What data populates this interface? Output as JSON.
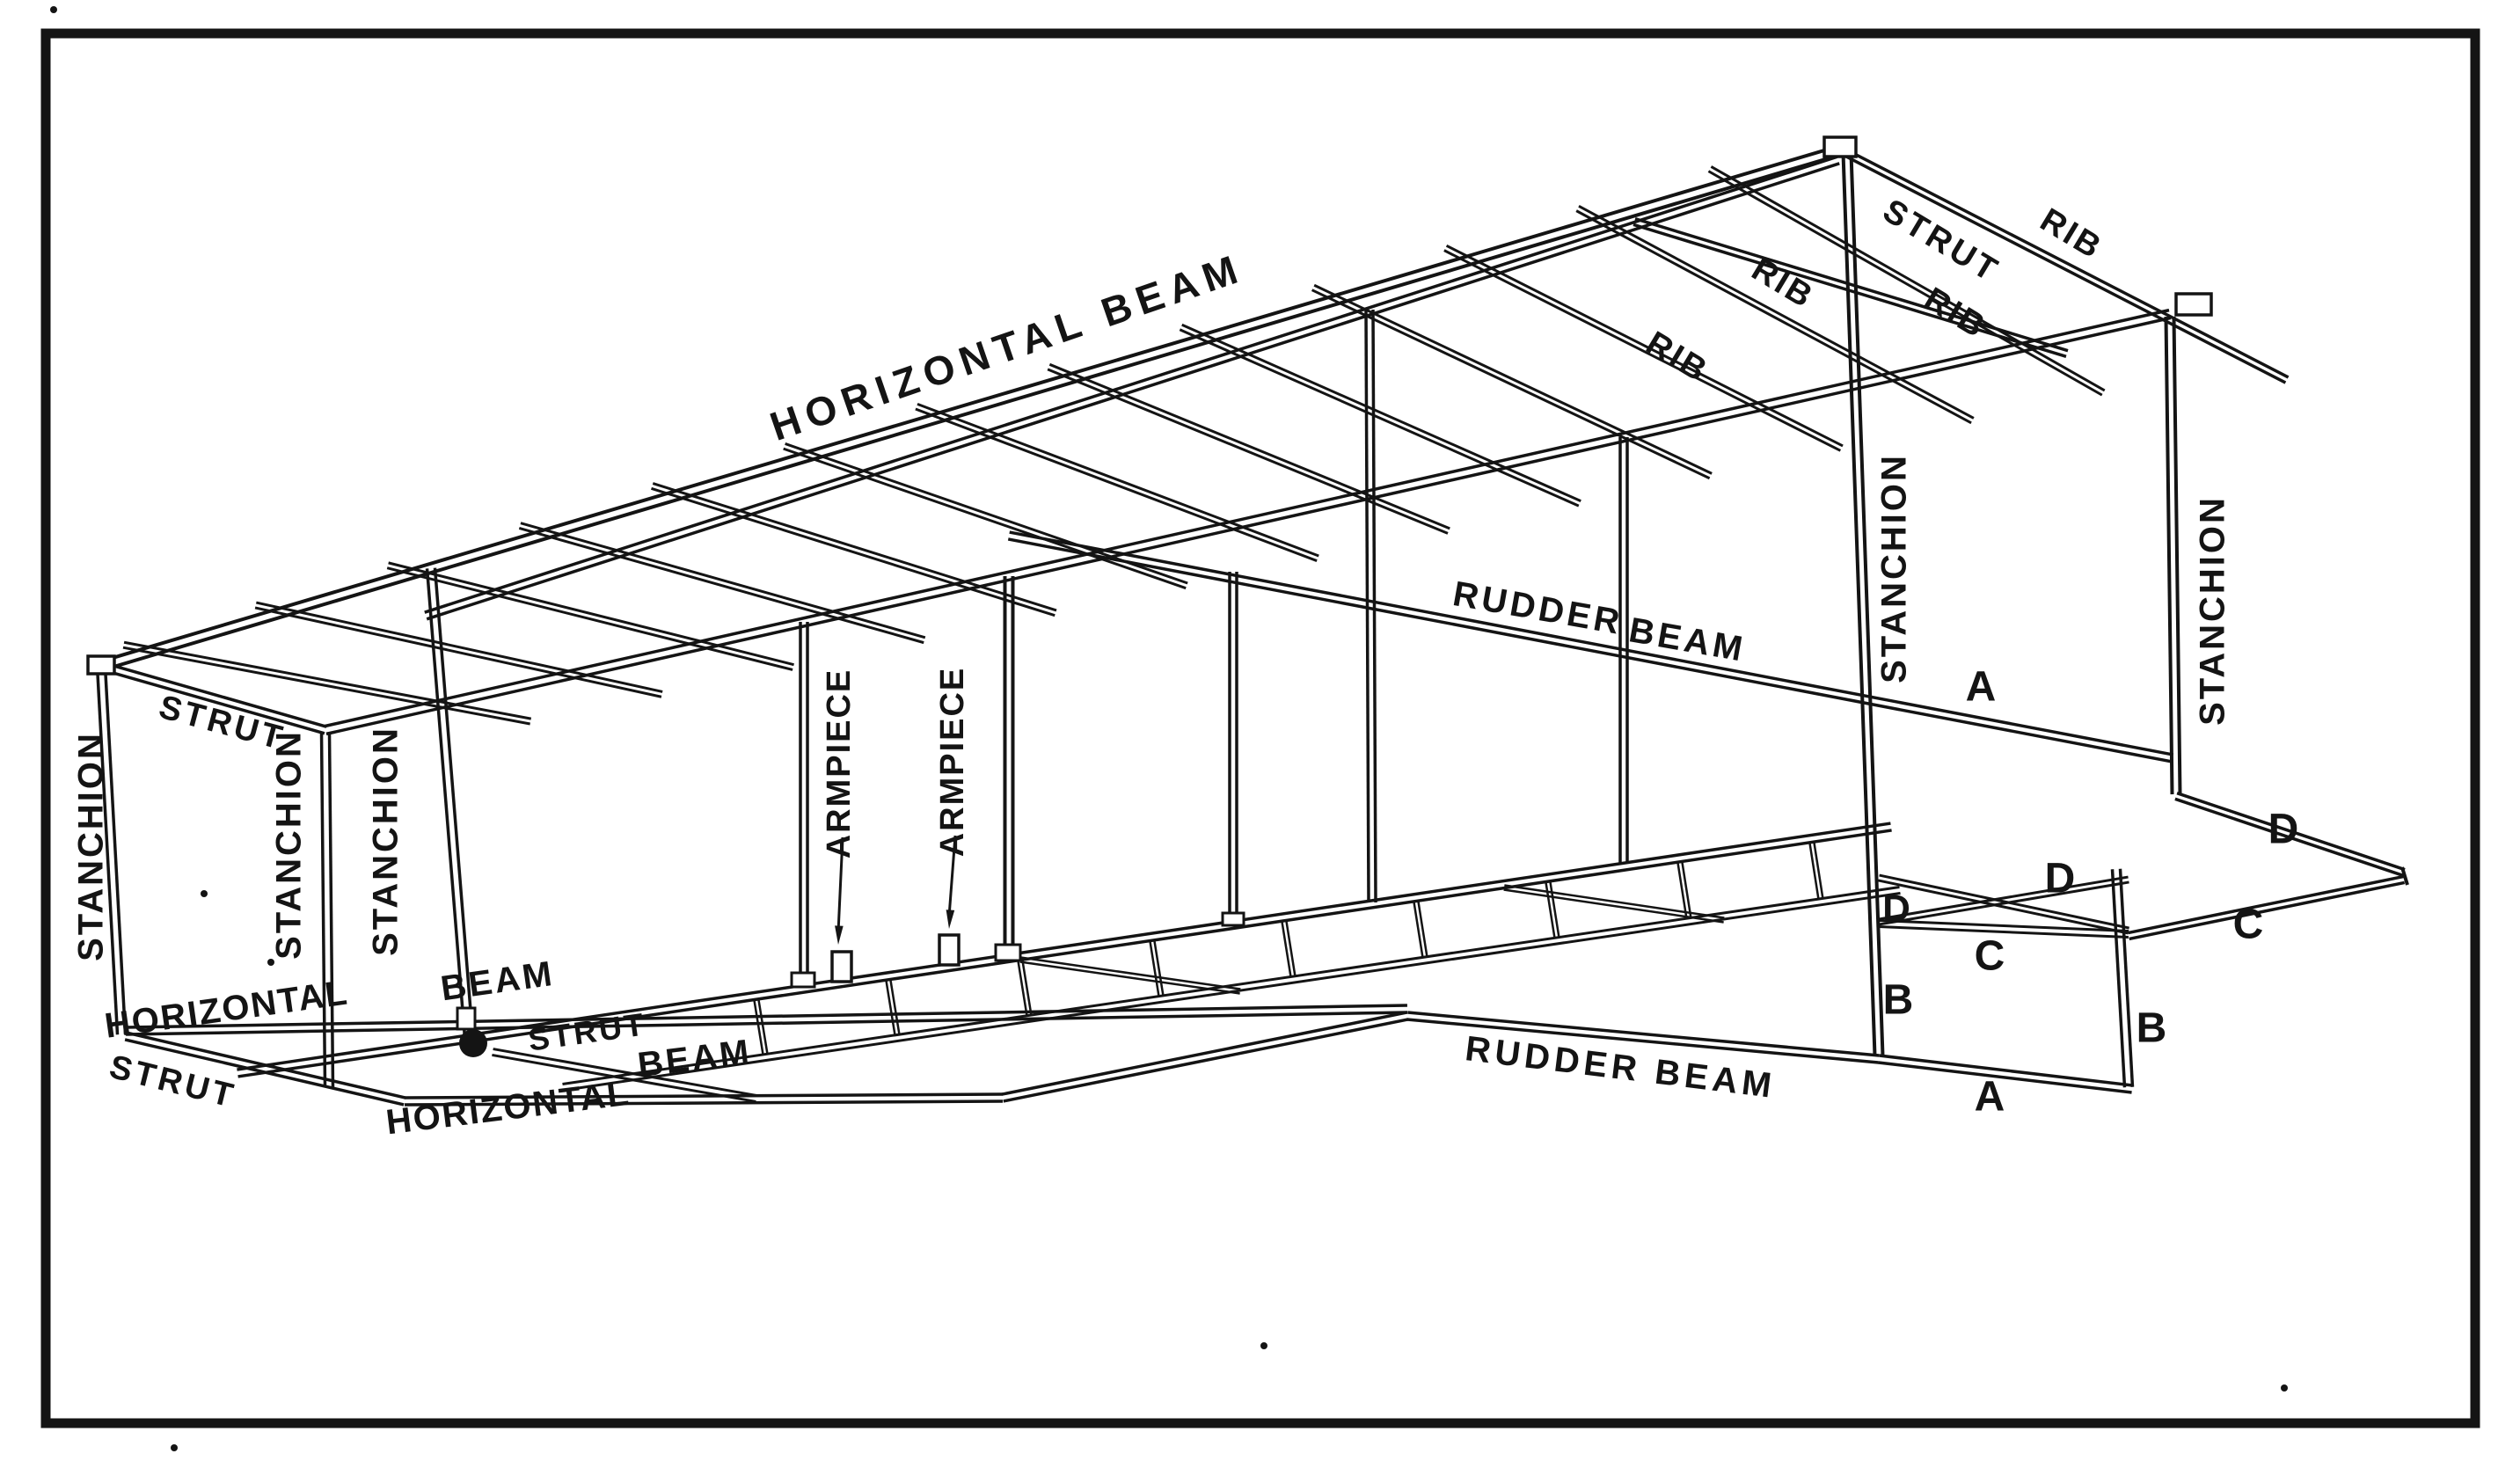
{
  "figure": {
    "kind": "technical line engraving",
    "subject": "Airplane tail outrigger framing: stanchions, struts, ribs, horizontal beams, rudder beams and armpieces",
    "colors": {
      "ink": "#141414",
      "paper": "#ffffff"
    }
  },
  "labels": [
    {
      "id": "horizontal-beam-top",
      "text": "HORIZONTAL BEAM"
    },
    {
      "id": "strut-top-right",
      "text": "STRUT"
    },
    {
      "id": "rib-1",
      "text": "RIB"
    },
    {
      "id": "rib-2",
      "text": "RIB"
    },
    {
      "id": "rib-3",
      "text": "RIB"
    },
    {
      "id": "rib-4",
      "text": "RIB"
    },
    {
      "id": "rudder-beam-upper-w1",
      "text": "RUDDER"
    },
    {
      "id": "rudder-beam-upper-w2",
      "text": "BEAM"
    },
    {
      "id": "stanchion-left-1",
      "text": "STANCHION"
    },
    {
      "id": "stanchion-left-2",
      "text": "STANCHION"
    },
    {
      "id": "stanchion-left-3",
      "text": "STANCHION"
    },
    {
      "id": "stanchion-right-near",
      "text": "STANCHION"
    },
    {
      "id": "stanchion-right-far",
      "text": "STANCHION"
    },
    {
      "id": "strut-top-left",
      "text": "STRUT"
    },
    {
      "id": "horizontal-mid",
      "text": "HORIZONTAL"
    },
    {
      "id": "beam-mid",
      "text": "BEAM"
    },
    {
      "id": "strut-mid",
      "text": "STRUT"
    },
    {
      "id": "armpiece-1",
      "text": "ARMPIECE"
    },
    {
      "id": "armpiece-2",
      "text": "ARMPIECE"
    },
    {
      "id": "strut-bottom-left",
      "text": "STRUT"
    },
    {
      "id": "horizontal-bottom",
      "text": "HORIZONTAL"
    },
    {
      "id": "beam-bottom",
      "text": "BEAM"
    },
    {
      "id": "rudder-beam-bottom",
      "text": "RUDDER BEAM"
    },
    {
      "id": "letter-a-upper",
      "text": "A"
    },
    {
      "id": "letter-a-lower",
      "text": "A"
    },
    {
      "id": "letter-b-left",
      "text": "B"
    },
    {
      "id": "letter-b-right",
      "text": "B"
    },
    {
      "id": "letter-c-left",
      "text": "C"
    },
    {
      "id": "letter-c-right",
      "text": "C"
    },
    {
      "id": "letter-d-left",
      "text": "D"
    },
    {
      "id": "letter-d-mid",
      "text": "D"
    },
    {
      "id": "letter-d-right",
      "text": "D"
    }
  ]
}
